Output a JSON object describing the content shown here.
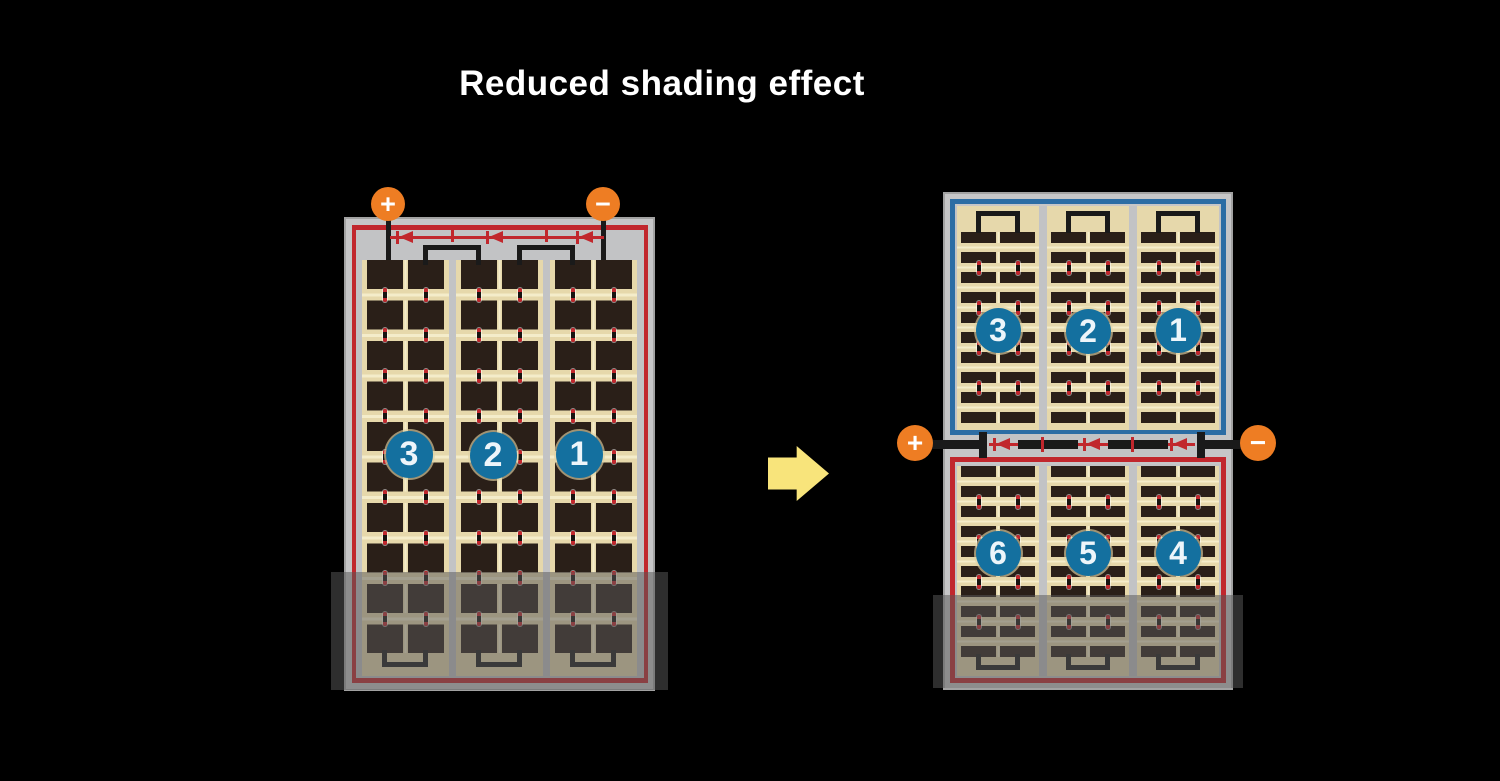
{
  "title": "Reduced shading effect",
  "left_module": {
    "description": "full-cell module with shaded bottom",
    "string_numbers": [
      "3",
      "2",
      "1"
    ],
    "terminal_positive": "+",
    "terminal_negative": "−",
    "bypass_diodes": 3,
    "cell_columns": 6,
    "cell_rows": 10
  },
  "right_module": {
    "description": "half-cut cell module with shaded bottom",
    "top_half_numbers": [
      "3",
      "2",
      "1"
    ],
    "bottom_half_numbers": [
      "6",
      "5",
      "4"
    ],
    "terminal_positive": "+",
    "terminal_negative": "−",
    "bypass_diodes": 3,
    "cell_columns": 6
  },
  "colors": {
    "background": "#000000",
    "title_text": "#ffffff",
    "frame_gray": "#c6c6c7",
    "inner_gray": "#c2c3c5",
    "red_accent": "#c1272d",
    "blue_accent": "#2c6da4",
    "circle_blue": "#14709f",
    "terminal_orange": "#ee7d23",
    "cell_dark": "#2a1f18",
    "cell_bg_tan": "#e6d8ab",
    "tan_light": "#f4ecca",
    "wire_black": "#1a1a1a",
    "arrow_yellow": "#f8e47b",
    "shading_overlay": "rgba(88,88,88,0.52)"
  }
}
